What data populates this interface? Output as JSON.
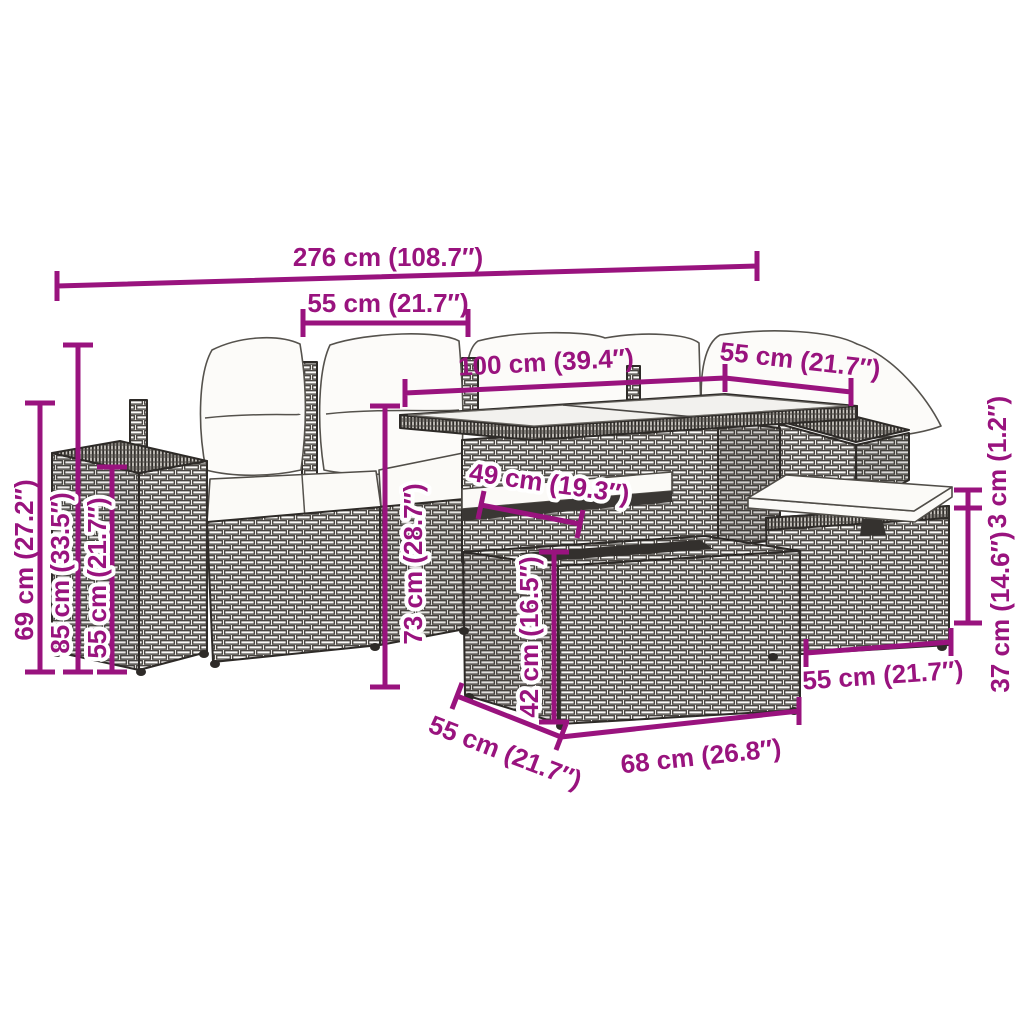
{
  "diagram": {
    "kind": "product-dimension-diagram",
    "subject": "rattan garden lounge set with table, ottoman and stool",
    "accent_color": "#99137e",
    "background_color": "#ffffff"
  },
  "dimensions": {
    "total_width": {
      "label": "276 cm (108.7″)"
    },
    "left_seat_width": {
      "label": "55 cm (21.7″)"
    },
    "table_length": {
      "label": "100 cm (39.4″)"
    },
    "right_section_depth": {
      "label": "55 cm (21.7″)"
    },
    "shelf_depth": {
      "label": "49 cm (19.3″)"
    },
    "seat_height": {
      "label": "69 cm (27.2″)"
    },
    "back_height": {
      "label": "85 cm (33.5″)"
    },
    "arm_height": {
      "label": "55 cm (21.7″)"
    },
    "table_height": {
      "label": "73 cm (28.7″)"
    },
    "ottoman_height": {
      "label": "42 cm (16.5″)"
    },
    "cushion_thickness": {
      "label": "3 cm (1.2″)"
    },
    "stool_height": {
      "label": "37 cm (14.6″)"
    },
    "stool_width": {
      "label": "55 cm (21.7″)"
    },
    "ottoman_depth": {
      "label": "55 cm (21.7″)"
    },
    "ottoman_width": {
      "label": "68 cm (26.8″)"
    }
  }
}
